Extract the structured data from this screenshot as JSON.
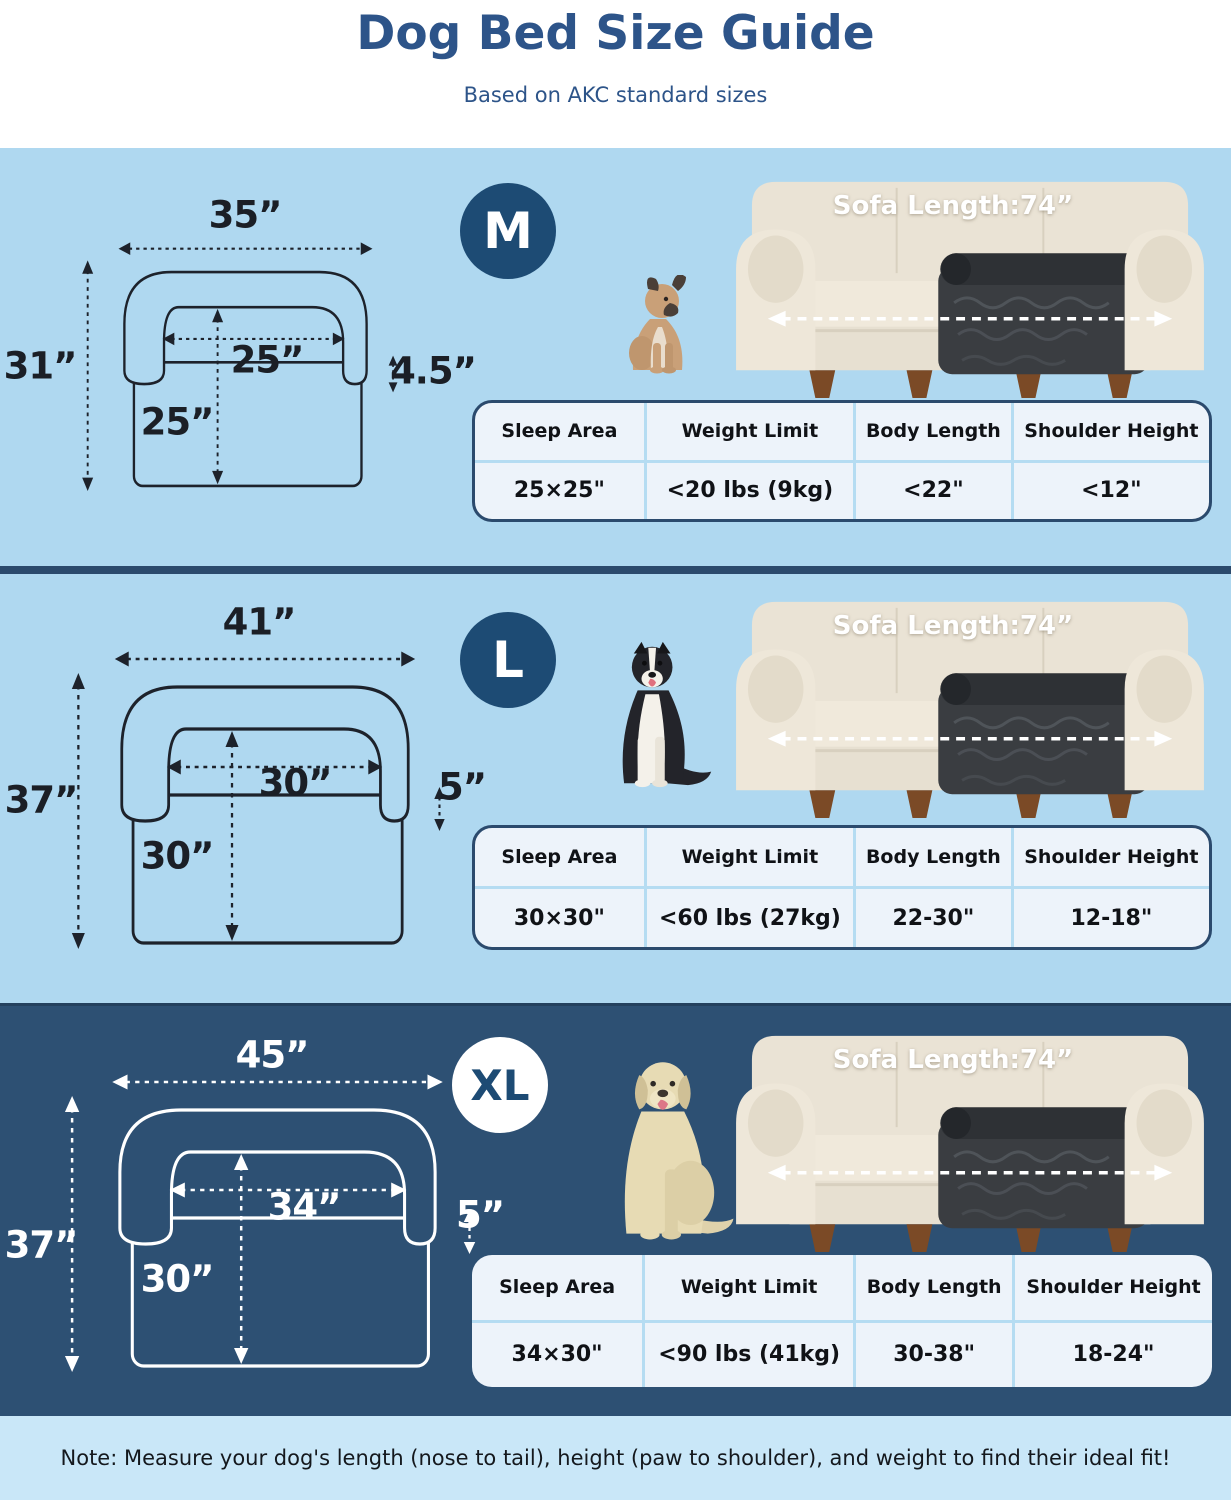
{
  "header": {
    "title": "Dog Bed Size Guide",
    "subtitle": "Based on AKC standard sizes"
  },
  "table_headers": [
    "Sleep Area",
    "Weight Limit",
    "Body Length",
    "Shoulder Height"
  ],
  "sections": [
    {
      "badge": "M",
      "dog": "french-bulldog",
      "sofa_label": "Sofa Length:74”",
      "dims": {
        "width": "35”",
        "height": "31”",
        "inner_width": "25”",
        "inner_height": "25”",
        "bolster_height": "4.5”"
      },
      "table": {
        "sleep_area": "25×25\"",
        "weight_limit": "<20 lbs (9kg)",
        "body_length": "<22\"",
        "shoulder_height": "<12\""
      }
    },
    {
      "badge": "L",
      "dog": "border-collie",
      "sofa_label": "Sofa Length:74”",
      "dims": {
        "width": "41”",
        "height": "37”",
        "inner_width": "30”",
        "inner_height": "30”",
        "bolster_height": "5”"
      },
      "table": {
        "sleep_area": "30×30\"",
        "weight_limit": "<60 lbs (27kg)",
        "body_length": "22-30\"",
        "shoulder_height": "12-18\""
      }
    },
    {
      "badge": "XL",
      "dog": "labrador",
      "sofa_label": "Sofa Length:74”",
      "dims": {
        "width": "45”",
        "height": "37”",
        "inner_width": "34”",
        "inner_height": "30”",
        "bolster_height": "5”"
      },
      "table": {
        "sleep_area": "34×30\"",
        "weight_limit": "<90 lbs (41kg)",
        "body_length": "30-38\"",
        "shoulder_height": "18-24\""
      }
    }
  ],
  "note": "Note: Measure your dog's length (nose to tail), height (paw to shoulder), and weight to find their ideal fit!",
  "colors": {
    "title_text": "#2d5489",
    "navy": "#2b4a6c",
    "badge_navy": "#1d4b74",
    "light_section_bg": "#afd8f0",
    "dark_section_bg": "#2d5073",
    "footer_bg": "#c9e7f8",
    "table_bg": "#edf3fa",
    "table_divider": "#b5dcf2"
  }
}
